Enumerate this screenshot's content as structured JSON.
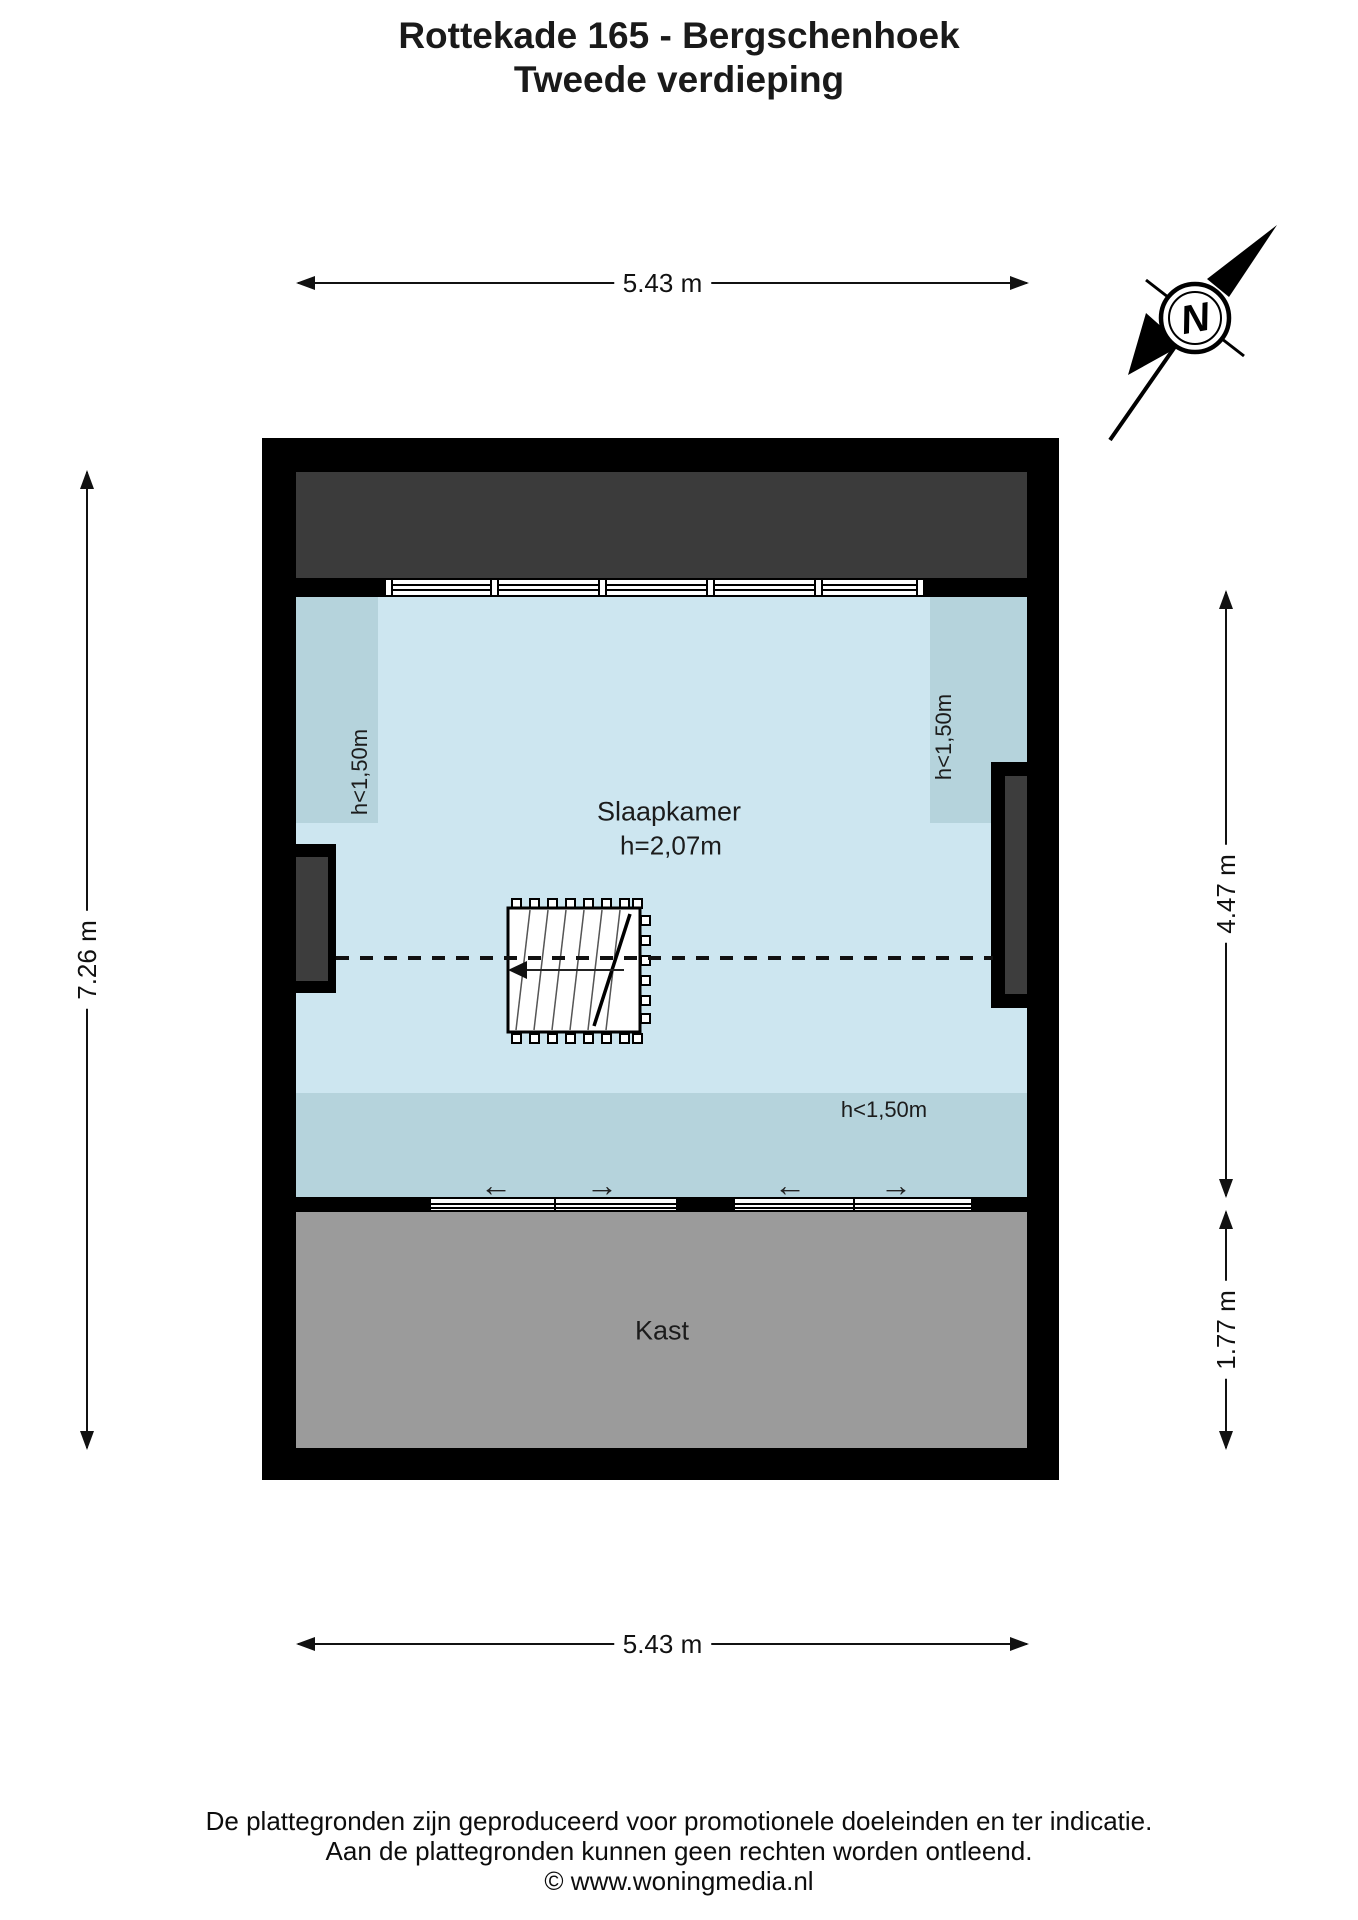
{
  "title": {
    "line1": "Rottekade 165 - Bergschenhoek",
    "line2": "Tweede verdieping"
  },
  "compass": {
    "north_label": "N"
  },
  "dimensions": {
    "top": "5.43 m",
    "bottom": "5.43 m",
    "left": "7.26 m",
    "right_upper": "4.47 m",
    "right_lower": "1.77 m"
  },
  "plan": {
    "rooms": {
      "bedroom": {
        "name": "Slaapkamer",
        "ceiling_height": "h=2,07m"
      },
      "closet": {
        "name": "Kast"
      }
    },
    "low_ceiling_label": "h<1,50m"
  },
  "icons": {
    "slide_left": "←",
    "slide_right": "→"
  },
  "colors": {
    "wall": "#000000",
    "roof_void": "#3b3b3b",
    "niche": "#3d3d3d",
    "room": "#cde6f0",
    "low_ceiling": "#b5d3dc",
    "closet": "#9b9b9b"
  },
  "footer": {
    "line1": "De plattegronden zijn geproduceerd voor promotionele doeleinden en ter indicatie.",
    "line2": "Aan de plattegronden kunnen geen rechten worden ontleend.",
    "line3": "© www.woningmedia.nl"
  }
}
